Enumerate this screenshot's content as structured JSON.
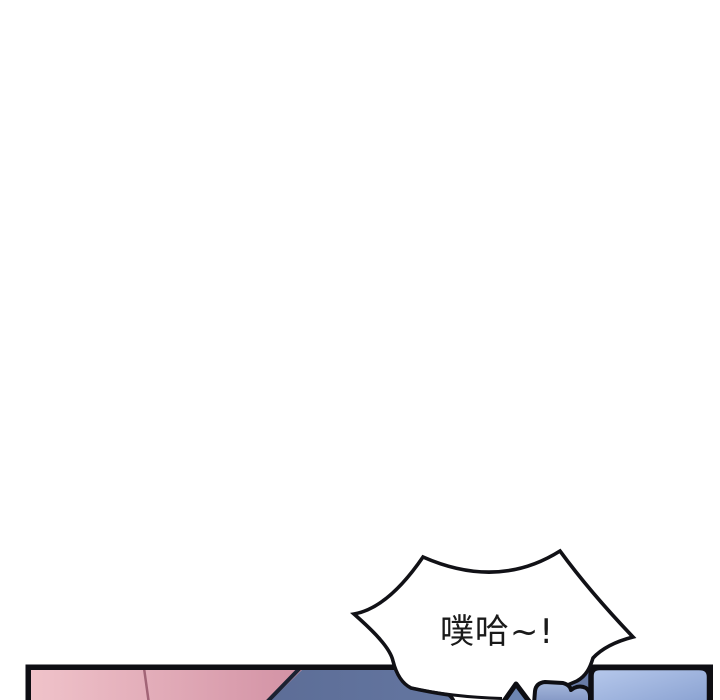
{
  "comic": {
    "speech_bubble": {
      "text": "噗哈~!",
      "fill": "#ffffff",
      "stroke": "#111116",
      "text_color": "#1a1a1a",
      "font_size": "34"
    },
    "panel": {
      "border_color": "#0e0e13",
      "colors": {
        "pink_light": "#f0c3ca",
        "pink_deep": "#d291a4",
        "pink_divider": "#a26476",
        "pink_edge": "#1b2232",
        "slate_left": "#53628a",
        "slate_right": "#6e82ae",
        "phone_light": "#b7c9ec",
        "phone_dark": "#89a1d1",
        "hand_light": "#a7b9dd",
        "hand_dark": "#8094c2",
        "wedge_fill": "#6d86b3",
        "ink": "#0e0e13"
      }
    },
    "page_background": "#ffffff"
  }
}
